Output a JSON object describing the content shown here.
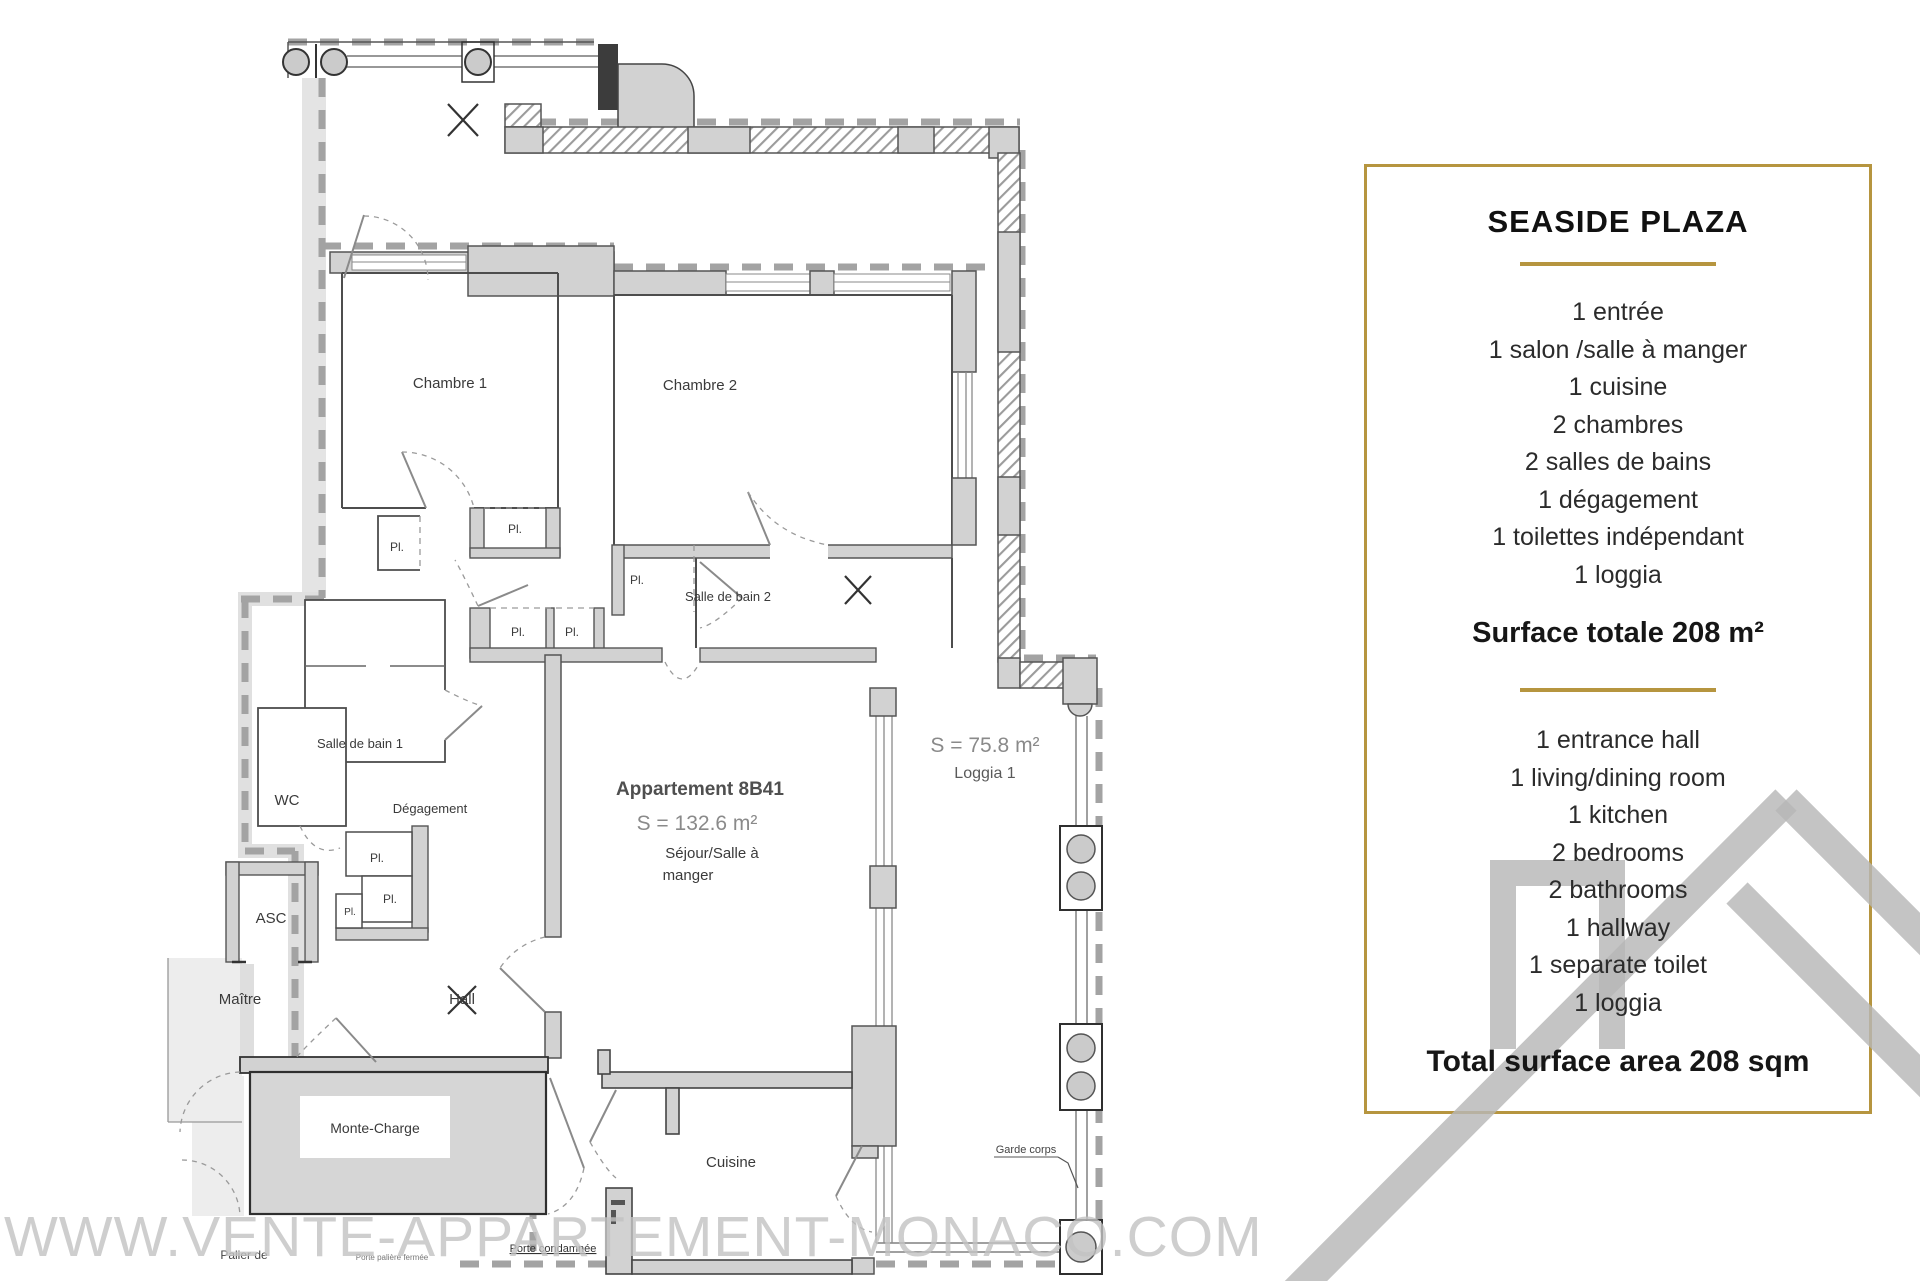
{
  "panel": {
    "title": "SEASIDE PLAZA",
    "accent_color": "#b6953f",
    "list_fr": [
      "1 entrée",
      "1 salon /salle à manger",
      "1 cuisine",
      "2 chambres",
      "2 salles de bains",
      "1 dégagement",
      "1 toilettes indépendant",
      "1 loggia"
    ],
    "surface_fr": "Surface totale 208 m²",
    "list_en": [
      "1 entrance hall",
      "1 living/dining room",
      "1 kitchen",
      "2 bedrooms",
      "2 bathrooms",
      "1 hallway",
      "1 separate toilet",
      "1 loggia"
    ],
    "surface_en": "Total surface area 208 sqm"
  },
  "plan": {
    "apartment_name": "Appartement 8B41",
    "apartment_area": "S = 132.6 m²",
    "sejour_line1": "Séjour/Salle à",
    "sejour_line2": "manger",
    "loggia_area": "S = 75.8 m²",
    "loggia_name": "Loggia 1",
    "rooms": {
      "chambre1": "Chambre 1",
      "chambre2": "Chambre 2",
      "sdb1": "Salle de bain 1",
      "sdb2": "Salle de bain 2",
      "wc": "WC",
      "degagement": "Dégagement",
      "asc": "ASC",
      "maitre": "Maître",
      "hall": "Hall",
      "monte_charge": "Monte-Charge",
      "cuisine": "Cuisine"
    },
    "closet": "Pl.",
    "garde_corps": "Garde corps",
    "notes": {
      "porte_condamnee": "Porte condamnée",
      "palier": "Palier de",
      "small_note": "Porte palière fermée"
    }
  },
  "watermark": "WWW.VENTE-APPARTEMENT-MONACO.COM"
}
